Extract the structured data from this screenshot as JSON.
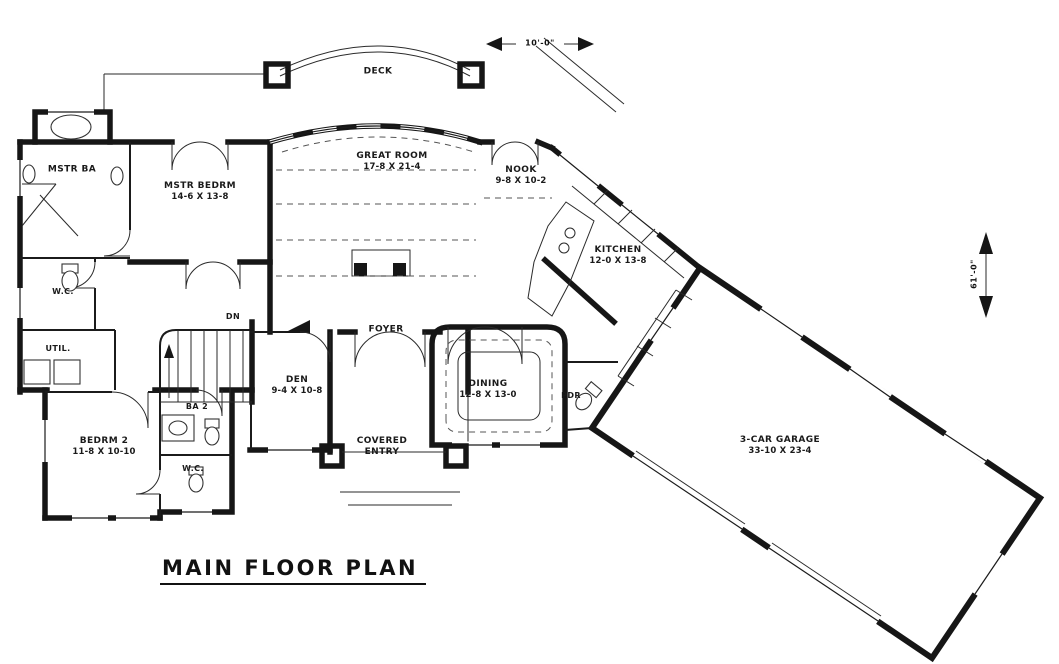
{
  "title": "MAIN FLOOR PLAN",
  "annotations": {
    "deck_width": "10'-0\"",
    "plan_depth": "61'-0\""
  },
  "rooms": {
    "deck": {
      "name": "DECK",
      "dims": ""
    },
    "mstr_ba": {
      "name": "MSTR BA",
      "dims": ""
    },
    "wc_master": {
      "name": "W.C.",
      "dims": ""
    },
    "util": {
      "name": "UTIL.",
      "dims": ""
    },
    "mstr_bedrm": {
      "name": "MSTR BEDRM",
      "dims": "14-6 X 13-8"
    },
    "great_room": {
      "name": "GREAT ROOM",
      "dims": "17-8 X 21-4"
    },
    "nook": {
      "name": "NOOK",
      "dims": "9-8 X 10-2"
    },
    "kitchen": {
      "name": "KITCHEN",
      "dims": "12-0 X 13-8"
    },
    "stairs": {
      "name": "DN",
      "dims": ""
    },
    "den": {
      "name": "DEN",
      "dims": "9-4 X 10-8"
    },
    "foyer": {
      "name": "FOYER",
      "dims": ""
    },
    "dining": {
      "name": "DINING",
      "dims": "12-8 X 13-0"
    },
    "pdr": {
      "name": "PDR",
      "dims": ""
    },
    "ba2": {
      "name": "BA 2",
      "dims": ""
    },
    "wc2": {
      "name": "W.C.",
      "dims": ""
    },
    "bedrm2": {
      "name": "BEDRM 2",
      "dims": "11-8 X 10-10"
    },
    "covered_entry": {
      "name": "COVERED ENTRY",
      "dims": ""
    },
    "garage": {
      "name": "3-CAR GARAGE",
      "dims": "33-10 X 23-4"
    }
  }
}
